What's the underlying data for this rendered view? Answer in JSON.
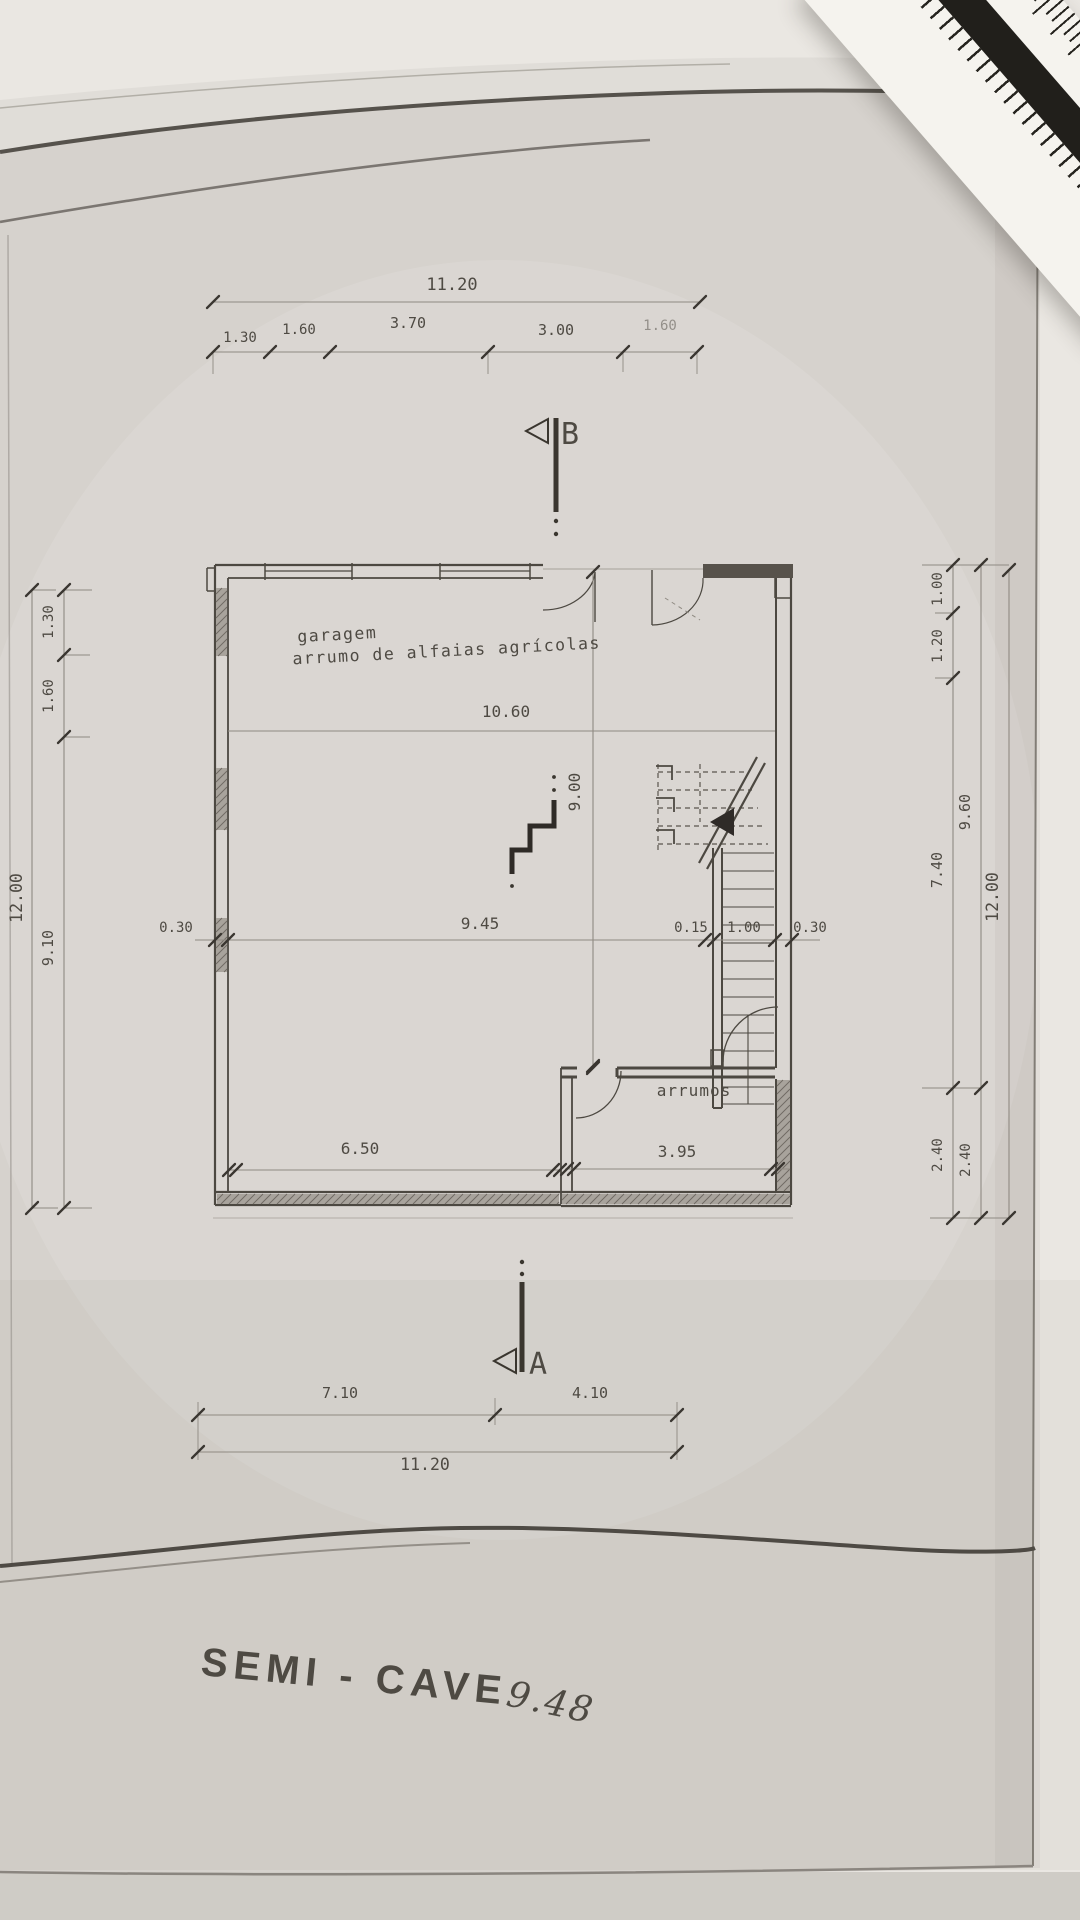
{
  "photo": {
    "title": "SEMI - CAVE",
    "handwritten_note": "9.48",
    "paper_color": "#d6d2cd",
    "ink_color": "#4c4841",
    "title_color": "#3d4147",
    "pencil_color": "#9b958c"
  },
  "plan": {
    "rooms": {
      "garage_label_line1": "garagem",
      "garage_label_line2": "arrumo de alfaias agrícolas",
      "storage_label": "arrumos"
    },
    "sections": {
      "top_marker": "B",
      "bottom_marker": "A"
    },
    "dims": {
      "top_total": "11.20",
      "top_seg_1": "1.30",
      "top_seg_2": "1.60",
      "top_seg_3": "3.70",
      "top_seg_4": "3.00",
      "top_seg_5": "1.60",
      "left_total": "12.00",
      "left_seg_1": "1.30",
      "left_seg_2": "1.60",
      "left_seg_3": "9.10",
      "right_seg_1": "1.00",
      "right_seg_2": "1.20",
      "right_seg_3": "7.40",
      "right_seg_4": "2.40",
      "right_mid_1": "9.60",
      "right_mid_2": "2.40",
      "right_total": "12.00",
      "inner_width": "10.60",
      "inner_height": "9.00",
      "row_left_wall": "0.30",
      "row_span": "9.45",
      "row_step": "0.15",
      "row_stair": "1.00",
      "row_right_wall": "0.30",
      "garage_width": "6.50",
      "storage_width": "3.95",
      "bottom_seg_1": "7.10",
      "bottom_seg_2": "4.10",
      "bottom_total": "11.20"
    }
  }
}
